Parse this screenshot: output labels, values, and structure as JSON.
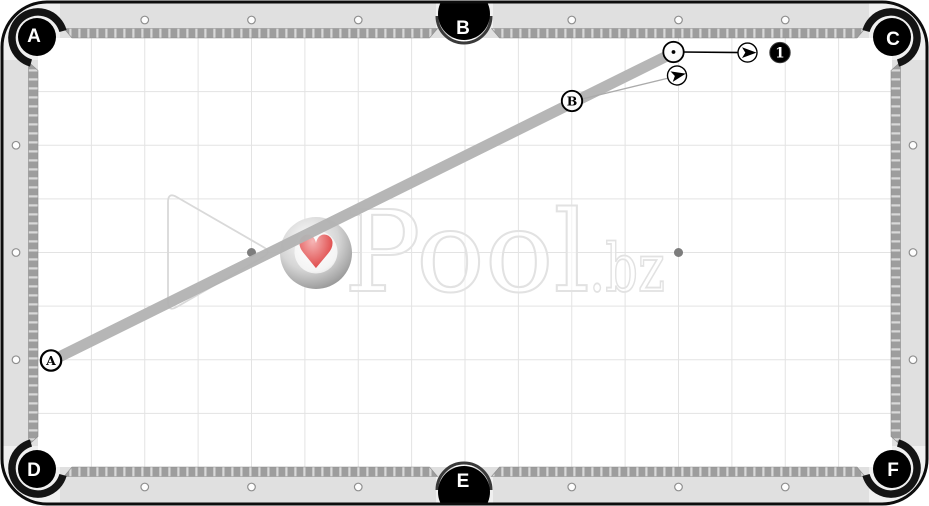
{
  "watermark": {
    "brand": "Pool",
    "suffix": ".bz",
    "heart_icon": "♥",
    "heart_color": "#e25757"
  },
  "table": {
    "surface_color": "#ffffff",
    "rail_color": "#e0e0e0",
    "cushion_color": "#9d9d9d",
    "grid_color": "#e3e3e3",
    "pockets": [
      {
        "id": "top-left",
        "label": "A"
      },
      {
        "id": "top-middle",
        "label": "B"
      },
      {
        "id": "top-right",
        "label": "C"
      },
      {
        "id": "bottom-left",
        "label": "D"
      },
      {
        "id": "bottom-middle",
        "label": "E"
      },
      {
        "id": "bottom-right",
        "label": "F"
      }
    ]
  },
  "diagram": {
    "shot_band": {
      "x1": 51,
      "y1": 361,
      "x2": 673,
      "y2": 53,
      "width": 11,
      "color": "#b3b3b3"
    },
    "aim_line": {
      "x1": 574,
      "y1": 101,
      "x2": 677,
      "y2": 76,
      "color": "#ababab"
    },
    "cue_arrow_line": {
      "x1": 682,
      "y1": 52,
      "x2": 743,
      "y2": 52.6,
      "color": "#000000"
    },
    "balls": [
      {
        "label": "A",
        "kind": "position-ball",
        "x": 51,
        "y": 360.5,
        "angle": 0
      },
      {
        "label": "B",
        "kind": "position-ball",
        "x": 572,
        "y": 101,
        "angle": 0
      },
      {
        "label": "",
        "kind": "cue-ball",
        "x": 673.5,
        "y": 52,
        "angle": 0
      },
      {
        "label": "1",
        "kind": "object-ball",
        "x": 780,
        "y": 52.6,
        "angle": 0
      }
    ],
    "direction_markers": [
      {
        "x": 747.5,
        "y": 52.6,
        "angle": 0
      },
      {
        "x": 677,
        "y": 75.5,
        "angle": -12
      }
    ],
    "spots": [
      {
        "x": 251.5,
        "y": 252.5
      },
      {
        "x": 678.5,
        "y": 252.5
      }
    ],
    "rack_outline": {
      "vertices": [
        [
          168,
          192
        ],
        [
          168,
          312
        ],
        [
          272,
          252
        ]
      ]
    }
  }
}
